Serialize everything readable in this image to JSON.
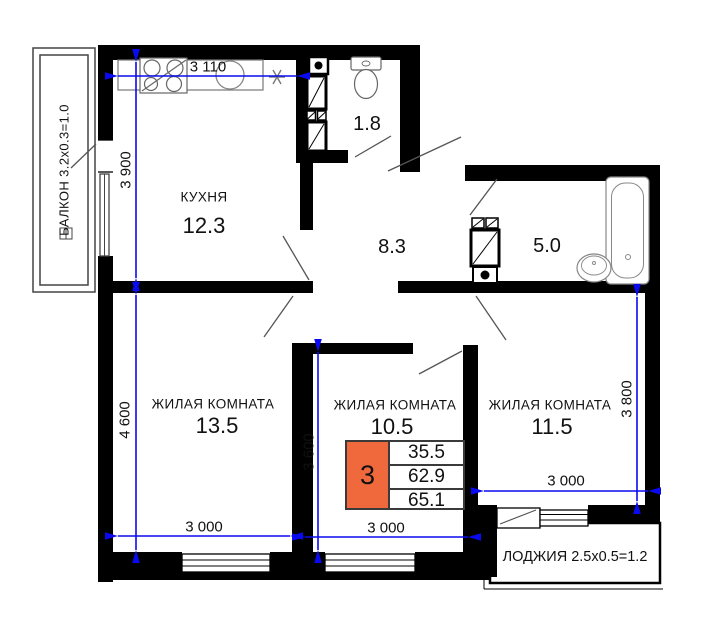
{
  "rooms": {
    "kitchen": {
      "name": "КУХНЯ",
      "area": "12.3"
    },
    "wc": {
      "area": "1.8"
    },
    "hallway": {
      "area": "8.3"
    },
    "bathroom": {
      "area": "5.0"
    },
    "living_room_1": {
      "name": "ЖИЛАЯ КОМНАТА",
      "area": "13.5"
    },
    "living_room_2": {
      "name": "ЖИЛАЯ КОМНАТА",
      "area": "10.5"
    },
    "living_room_3": {
      "name": "ЖИЛАЯ КОМНАТА",
      "area": "11.5"
    }
  },
  "balcony": {
    "label": "БАЛКОН 3.2x0.3=1.0"
  },
  "loggia": {
    "label": "ЛОДЖИЯ 2.5x0.5=1.2"
  },
  "dimensions_mm": {
    "kitchen_width": "3 110",
    "kitchen_depth": "3 900",
    "living1_depth": "4 600",
    "living1_width": "3 000",
    "living2_depth": "3 600",
    "living2_width": "3 000",
    "living3_depth": "3 800",
    "living3_width": "3 000"
  },
  "info_box": {
    "room_count": "3",
    "living_area": "35.5",
    "apartment_area": "62.9",
    "total_area": "65.1"
  },
  "colors": {
    "dimension_line": "#0a0af0",
    "info_box_accent": "#f0693c",
    "walls": "#000000"
  }
}
